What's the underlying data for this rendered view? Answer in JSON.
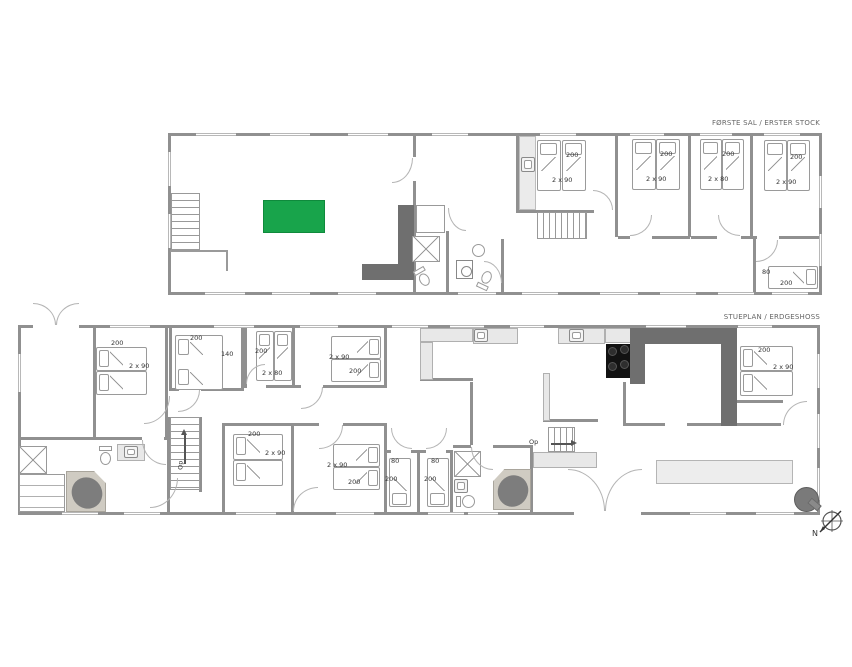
{
  "floor1": {
    "title": "FØRSTE SAL / ERSTER STOCK",
    "bedrooms": [
      {
        "size": "2 x 90",
        "len": "200"
      },
      {
        "size": "2 x 90",
        "len": "200"
      },
      {
        "size": "2 x 80",
        "len": "200"
      },
      {
        "size": "2 x 90",
        "len": "200"
      },
      {
        "size": "80",
        "len": "200"
      }
    ]
  },
  "floor0": {
    "title": "STUEPLAN / ERDGESHOSS",
    "stairs_up_label": "Op",
    "stairs_up_label_left": "Op",
    "bedrooms": [
      {
        "size": "2 x 90",
        "len": "200"
      },
      {
        "size": "140",
        "len": "200"
      },
      {
        "size": "2 x 80",
        "len": "200"
      },
      {
        "size": "2 x 90",
        "len": "200"
      },
      {
        "size": "2 x 90",
        "len": "200"
      },
      {
        "size": "2 x 90",
        "len": "200"
      },
      {
        "size": "80",
        "len": "200"
      },
      {
        "size": "80",
        "len": "200"
      },
      {
        "size": "2 x 90",
        "len": "200"
      }
    ]
  },
  "compass": {
    "north_label": "N"
  },
  "colors": {
    "table_green": "#18a44b",
    "counter_dark": "#6f6f6f",
    "wall_gray": "#909090"
  }
}
